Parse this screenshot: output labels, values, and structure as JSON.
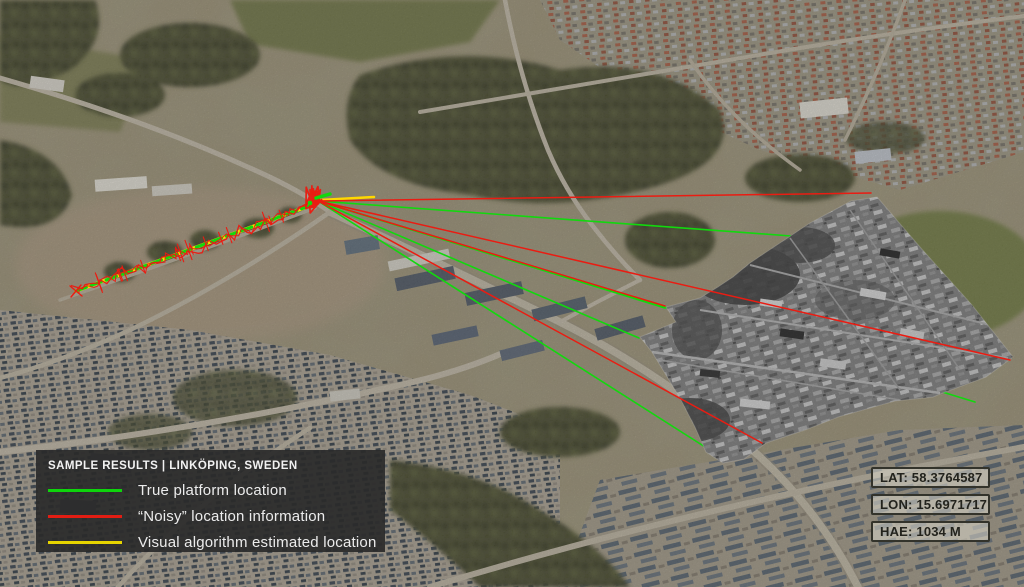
{
  "legend": {
    "title": "SAMPLE RESULTS | LINKÖPING, SWEDEN",
    "items": [
      {
        "name": "true-platform-location",
        "color": "#0ed40c",
        "label": "True platform location"
      },
      {
        "name": "noisy-location-information",
        "color": "#e21d13",
        "label": "“Noisy” location information"
      },
      {
        "name": "visual-algorithm-estimated-location",
        "color": "#e6d400",
        "label": "Visual algorithm estimated location"
      }
    ]
  },
  "telemetry": {
    "lat": "LAT: 58.3764587",
    "lon": "LON: 15.6971717",
    "hae": "HAE: 1034 M"
  },
  "overlay": {
    "colors": {
      "true_platform": "#12d80e",
      "noisy": "#ea1c12",
      "estimate": "#ffd800"
    },
    "convergence_px": [
      318,
      201
    ],
    "platform_track_px": {
      "start": [
        76,
        291
      ],
      "end": [
        312,
        205
      ]
    },
    "true_rays_px": [
      [
        791,
        236
      ],
      [
        975,
        402
      ],
      [
        665,
        308
      ],
      [
        639,
        338
      ],
      [
        724,
        459
      ]
    ],
    "noisy_rays_px": [
      [
        871,
        193
      ],
      [
        1010,
        360
      ],
      [
        665,
        306
      ],
      [
        762,
        443
      ]
    ],
    "estimate_segment_px": [
      [
        320,
        200
      ],
      [
        374,
        197
      ]
    ]
  }
}
